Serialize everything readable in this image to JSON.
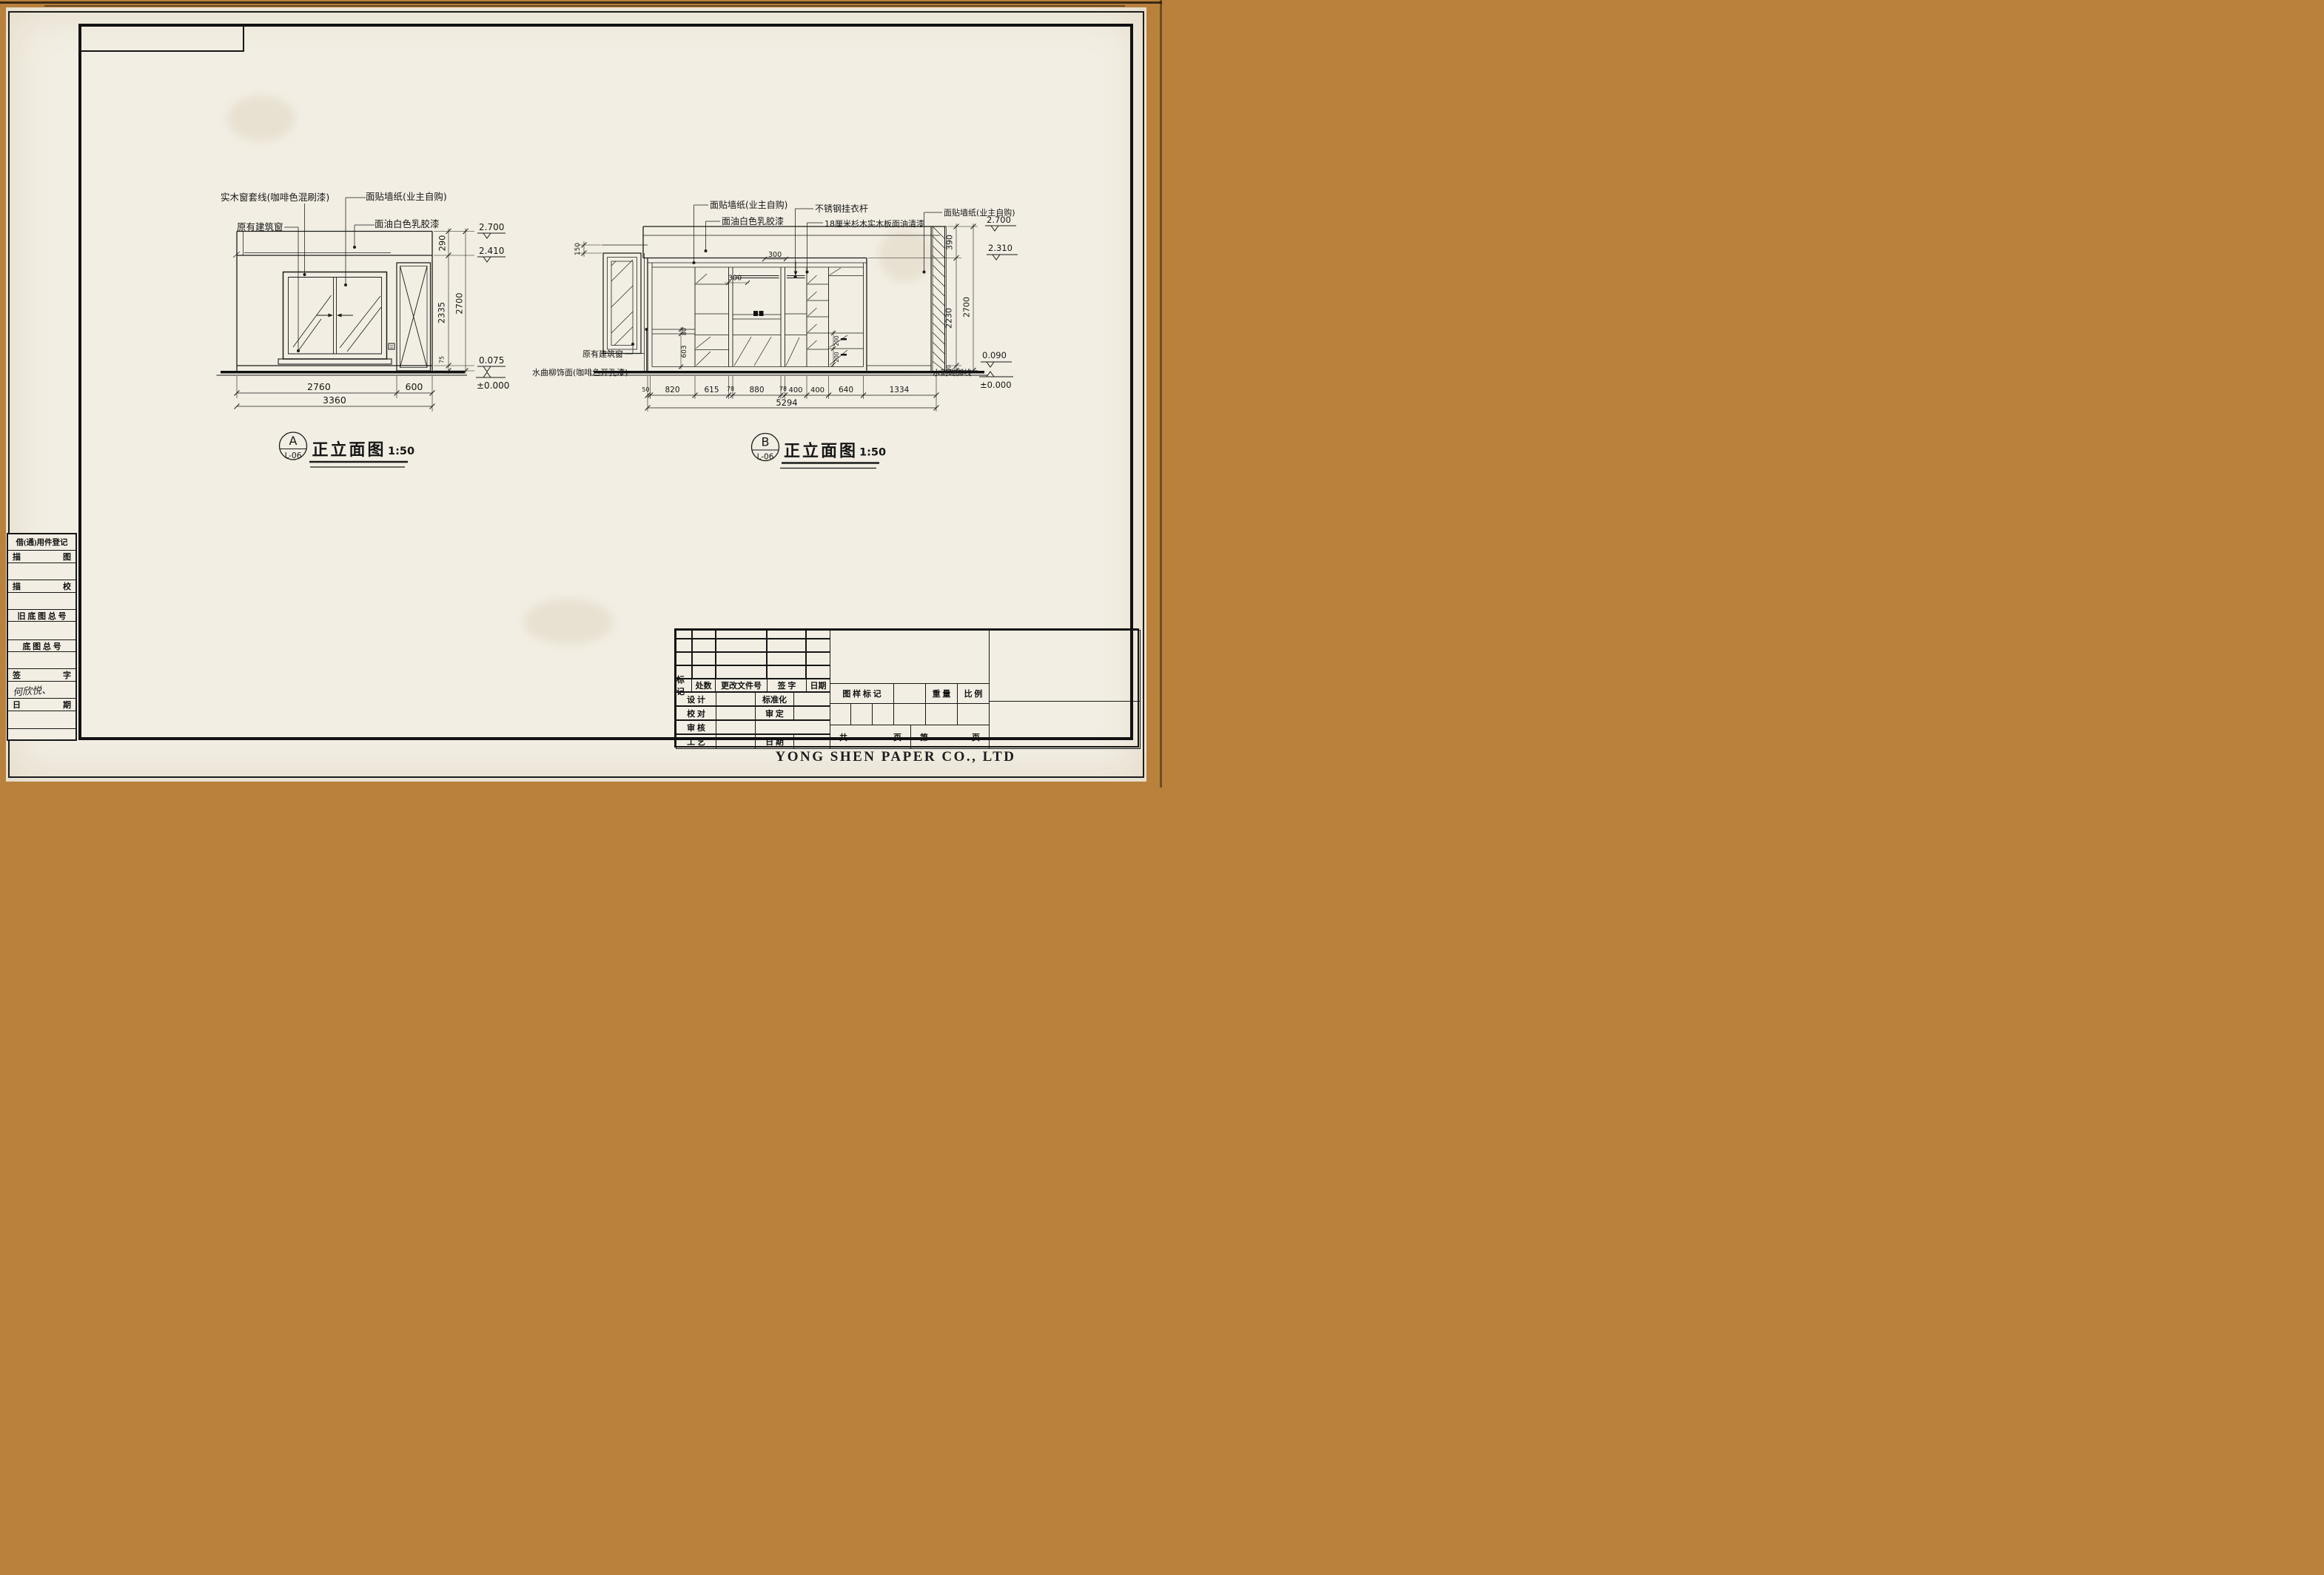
{
  "company": "YONG SHEN PAPER CO., LTD",
  "sidebar": {
    "register": "借(通)用件登记",
    "row1l": "描",
    "row1r": "图",
    "row2l": "描",
    "row2r": "校",
    "row3": "旧 底 图 总 号",
    "row4": "底 图 总 号",
    "row5l": "签",
    "row5r": "字",
    "signature": "何欣悦、",
    "row6l": "日",
    "row6r": "期"
  },
  "title_block": {
    "rev": {
      "c1": "标记",
      "c2": "处数",
      "c3": "更改文件号",
      "c4": "签  字",
      "c5": "日期"
    },
    "r1l": "设  计",
    "r1r": "标准化",
    "r2l": "校  对",
    "r2r": "审  定",
    "r3l": "审  核",
    "r3r": "",
    "r4l": "工  艺",
    "r4r": "日  期",
    "stamp": "图 样 标 记",
    "weight": "重 量",
    "scale": "比 例",
    "pages": {
      "gong": "共",
      "ye1": "页",
      "di": "第",
      "ye2": "页"
    }
  },
  "elev_a": {
    "tag": "A",
    "ref": "L-06",
    "title": "正立面图",
    "scale": "1:50",
    "note_casing": "实木窗套线(咖啡色混刷漆)",
    "note_window": "原有建筑窗",
    "note_wallpaper": "面贴墙纸(业主自购)",
    "note_paint": "面油白色乳胶漆",
    "lv1": "2.700",
    "lv2": "2.410",
    "lv3": "0.075",
    "lv4": "±0.000",
    "v1": "290",
    "v2": "2335",
    "v3": "75",
    "v4": "2700",
    "h1": "2760",
    "h2": "600",
    "h3": "3360"
  },
  "elev_b": {
    "tag": "B",
    "ref": "L-06",
    "title": "正立面图",
    "scale": "1:50",
    "note_wallpaper_l": "面贴墙纸(业主自购)",
    "note_paint": "面油白色乳胶漆",
    "note_rod": "不锈钢挂衣杆",
    "note_board": "18厘米杉木实木板面油清漆",
    "note_wallpaper_r": "面贴墙纸(业主自购)",
    "note_window": "原有建筑窗",
    "note_veneer": "水曲柳饰面(咖啡色开孔漆)",
    "note_skirting": "水割踢脚线",
    "lv1": "2.700",
    "lv2": "2.310",
    "lv3": "0.090",
    "lv4": "±0.000",
    "v_150": "150",
    "v_390": "390",
    "v_2230": "2230",
    "v_90": "90",
    "v_2700": "2700",
    "v_80": "80",
    "v_603": "603",
    "v_200a": "200",
    "v_200b": "200",
    "i_300a": "300",
    "i_300b": "300",
    "h1": "50",
    "h2": "820",
    "h3": "615",
    "h4": "78",
    "h5": "880",
    "h6": "78",
    "h7": "400",
    "h8": "400",
    "h9": "640",
    "h10": "1334",
    "htotal": "5294"
  }
}
